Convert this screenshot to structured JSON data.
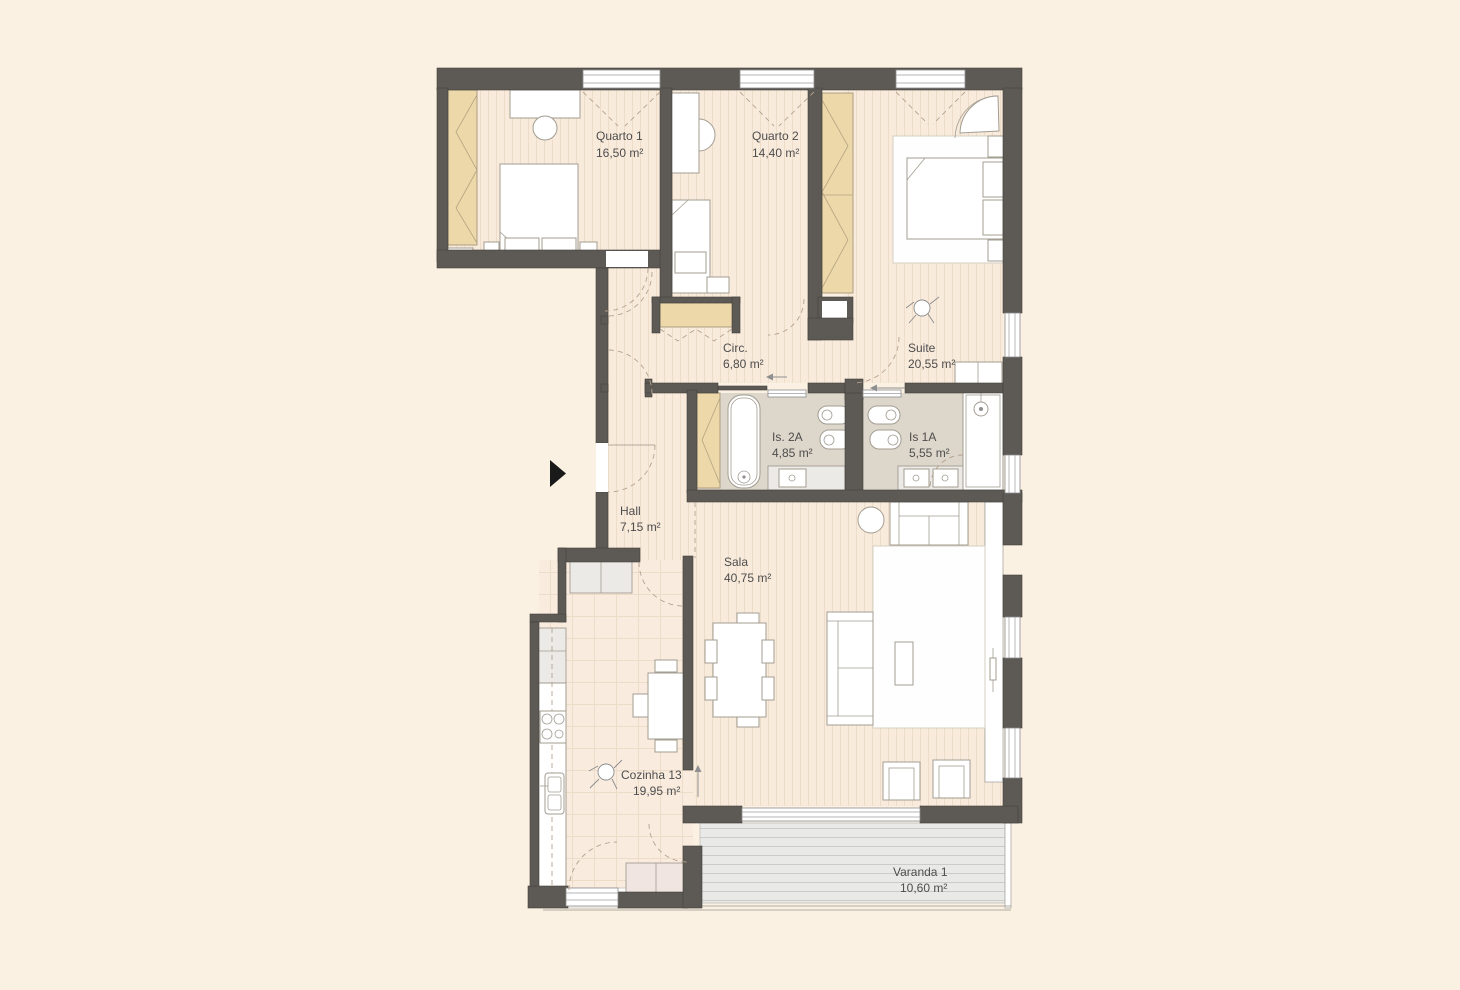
{
  "title": "Apartment floor plan",
  "rooms": [
    {
      "id": "quarto1",
      "name": "Quarto 1",
      "area": "16,50 m²"
    },
    {
      "id": "quarto2",
      "name": "Quarto 2",
      "area": "14,40 m²"
    },
    {
      "id": "suite",
      "name": "Suite",
      "area": "20,55 m²"
    },
    {
      "id": "circ",
      "name": "Circ.",
      "area": "6,80 m²"
    },
    {
      "id": "is2a",
      "name": "Is. 2A",
      "area": "4,85 m²"
    },
    {
      "id": "is1a",
      "name": "Is 1A",
      "area": "5,55 m²"
    },
    {
      "id": "hall",
      "name": "Hall",
      "area": "7,15 m²"
    },
    {
      "id": "sala",
      "name": "Sala",
      "area": "40,75 m²"
    },
    {
      "id": "cozinha",
      "name": "Cozinha 13",
      "area": "19,95 m²"
    },
    {
      "id": "varanda",
      "name": "Varanda 1",
      "area": "10,60 m²"
    }
  ],
  "markers": {
    "entrance_arrow": "black triangle pointing right at apartment entrance door",
    "circ_direction_arrow": "←",
    "suite_bath_direction_arrow": "←",
    "sala_passage_direction_arrow": "↑"
  },
  "palette": {
    "background": "#fbf1e2",
    "wall": "#5d5a55",
    "floor": "#f9ebdc",
    "stripe": "#ecdcc8",
    "bath_floor": "#ddd6ca",
    "wardrobe": "#ecd8a8",
    "deck": "#e9e9e7",
    "deck_line": "#cbcbc8",
    "counter": "#eceae6",
    "cabinet_pink": "#f0e5e1",
    "text": "#4d4d4d",
    "arc": "#b5a28f",
    "furniture_line": "#a39d92",
    "entrance_marker": "#1a1a1a"
  }
}
